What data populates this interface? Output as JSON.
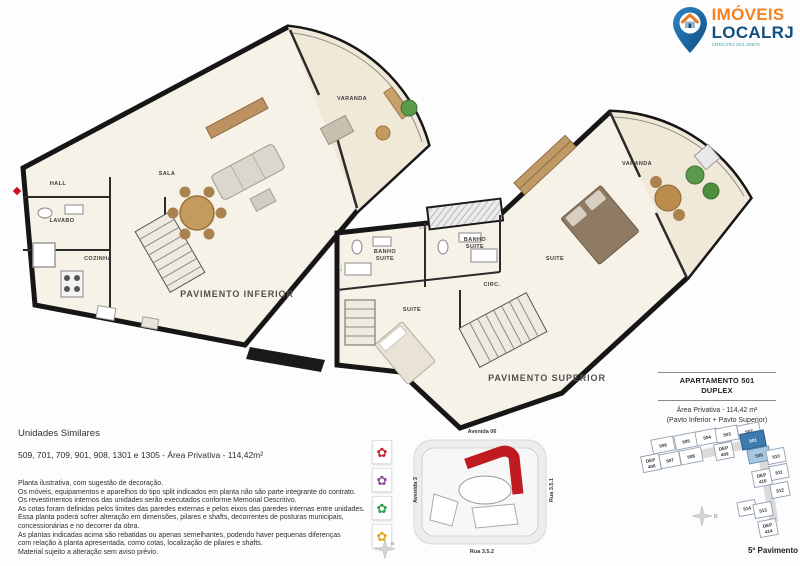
{
  "logo": {
    "name_top": "IMÓVEIS",
    "name_bottom": "LOCALRJ",
    "registration": "CRECI/RJ 001.306/O",
    "orange": "#f5821f",
    "navy": "#11507e",
    "teal": "#2aa0a0"
  },
  "plan_inferior": {
    "caption": "PAVIMENTO INFERIOR",
    "rooms": {
      "hall": "HALL",
      "sala": "SALA",
      "lavabo": "LAVABO",
      "cozinha": "COZINHA",
      "varanda": "VARANDA"
    }
  },
  "plan_superior": {
    "caption": "PAVIMENTO SUPERIOR",
    "rooms": {
      "banho1_l1": "BANHO",
      "banho1_l2": "SUITE",
      "banho2_l1": "BANHO",
      "banho2_l2": "SUITE",
      "circ": "CIRC.",
      "suite2": "SUITE",
      "suite_master": "SUITE",
      "varanda": "VARANDA"
    },
    "dims": {
      "d1": "2.77",
      "d2": "2.95"
    }
  },
  "notes": {
    "title": "Unidades Similares",
    "units_line": "509, 701, 709, 901, 908, 1301 e 1305 - Área Privativa - 114,42m²",
    "disclaimer": [
      "Planta ilustrativa, com sugestão de decoração.",
      "Os móveis, equipamentos e aparelhos do tipo split indicados em planta não são parte integrante do contrato.",
      "Os revestimentos internos das unidades serão executados conforme Memorial Descritivo.",
      "As cotas foram definidas pelos limites das paredes externas e pelos eixos das paredes internas entre unidades.",
      "Essa planta poderá sofrer alteração em dimensões, pilares e shafts, decorrentes de posturas  municipais,",
      "concessionárias e no decorrer da obra.",
      "As plantas indicadas acima são rebatidas ou apenas semelhantes, podendo haver pequenas diferenças",
      "com relação à planta apresentada, como cotas, localização de pilares e shafts.",
      "Material sujeito a alteração sem aviso prévio."
    ]
  },
  "site_plan": {
    "streets": {
      "top": "Avenida 06",
      "left": "Avenida 3",
      "right": "Rua 3.5.1",
      "bottom": "Rua 3.5.2"
    },
    "building_color": "#bf1b20",
    "legend": [
      {
        "name": "red-flower",
        "color": "#c4232b",
        "glyph": "✿"
      },
      {
        "name": "purple-flower",
        "color": "#8c4a9c",
        "glyph": "✿"
      },
      {
        "name": "green-flower",
        "color": "#2f9e45",
        "glyph": "✿"
      },
      {
        "name": "yellow-flower",
        "color": "#e2a31c",
        "glyph": "✿"
      }
    ]
  },
  "apartment_info": {
    "title_line1": "APARTAMENTO 501",
    "title_line2": "DUPLEX",
    "area_line": "Área Privativa - 114,42 m²",
    "pavtos_line": "(Pavto Inferior + Pavto Superior)",
    "floor_label": "5º Pavimento",
    "highlight_dark": "#3d7ab0",
    "highlight_light": "#a6c8e0"
  },
  "keyplan": {
    "north": "N",
    "units": [
      {
        "label": "506"
      },
      {
        "label": "505"
      },
      {
        "label": "504"
      },
      {
        "label": "503"
      },
      {
        "label": "502"
      },
      {
        "l1": "DEP",
        "l2": "406"
      },
      {
        "label": "507"
      },
      {
        "label": "508"
      },
      {
        "l1": "DEP",
        "l2": "409"
      },
      {
        "label": "501"
      },
      {
        "label": "509"
      },
      {
        "label": "510"
      },
      {
        "label": "511"
      },
      {
        "l1": "DEP",
        "l2": "416"
      },
      {
        "label": "512"
      },
      {
        "label": "514"
      },
      {
        "label": "513"
      },
      {
        "l1": "DEP",
        "l2": "414"
      }
    ]
  }
}
